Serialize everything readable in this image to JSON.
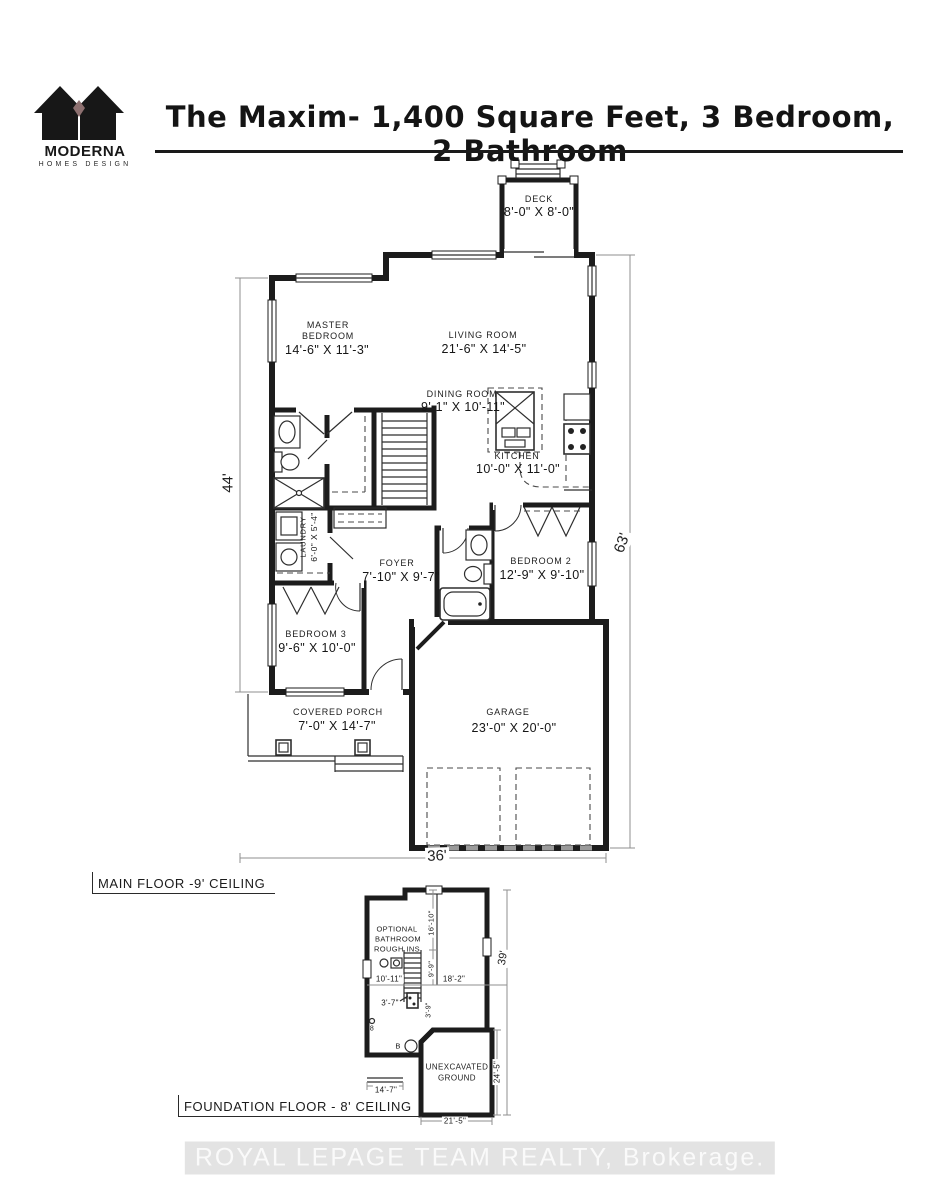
{
  "header": {
    "brand_name": "MODERNA",
    "brand_tagline": "HOMES DESIGN",
    "title": "The Maxim- 1,400 Square Feet, 3 Bedroom, 2 Bathroom"
  },
  "main_floor": {
    "caption": "MAIN FLOOR -9' CEILING",
    "deck": {
      "name": "DECK",
      "dims": "8'-0\" X 8'-0\""
    },
    "master_bedroom": {
      "line1": "MASTER",
      "line2": "BEDROOM",
      "dims": "14'-6\" X 11'-3\""
    },
    "living_room": {
      "name": "LIVING ROOM",
      "dims": "21'-6\" X 14'-5\""
    },
    "dining_room": {
      "name": "DINING ROOM",
      "dims": "9'-1\" X 10'-11\""
    },
    "kitchen": {
      "name": "KITCHEN",
      "dims": "10'-0\" X 11'-0\""
    },
    "laundry": {
      "name": "LAUNDRY",
      "dims": "6'-0\" X 5'-4\""
    },
    "foyer": {
      "name": "FOYER",
      "dims": "7'-10\" X 9'-7\""
    },
    "bedroom_2": {
      "name": "BEDROOM 2",
      "dims": "12'-9\" X 9'-10\""
    },
    "bedroom_3": {
      "name": "BEDROOM 3",
      "dims": "9'-6\" X 10'-0\""
    },
    "covered_porch": {
      "name": "COVERED PORCH",
      "dims": "7'-0\" X 14'-7\""
    },
    "garage": {
      "name": "GARAGE",
      "dims": "23'-0\" X 20'-0\""
    },
    "dim_bottom": "36'",
    "dim_left": "44'",
    "dim_right": "63'"
  },
  "foundation": {
    "caption": "FOUNDATION FLOOR - 8' CEILING",
    "optional_bath": {
      "line1": "OPTIONAL",
      "line2": "BATHROOM",
      "line3": "ROUGH INS"
    },
    "unexcavated": {
      "line1": "UNEXCAVATED",
      "line2": "GROUND"
    },
    "dims": {
      "d16_10": "16'-10\"",
      "d9_9": "9'-9\"",
      "d10_11": "10'-11\"",
      "d18_2": "18'-2\"",
      "d3_7": "3'-7\"",
      "d3_9": "3'-9\"",
      "d14_7": "14'-7\"",
      "d21_5": "21'-5\"",
      "d24_5": "24'-5\"",
      "d39": "39'"
    },
    "markers": {
      "m8": "8",
      "mB": "B"
    }
  },
  "watermark": "ROYAL LEPAGE TEAM REALTY, Brokerage.",
  "colors": {
    "ink": "#1c1c1c",
    "dim_line": "#8f8f8f",
    "watermark_text": "#fafafa",
    "watermark_bg": "#e3e3e3"
  }
}
